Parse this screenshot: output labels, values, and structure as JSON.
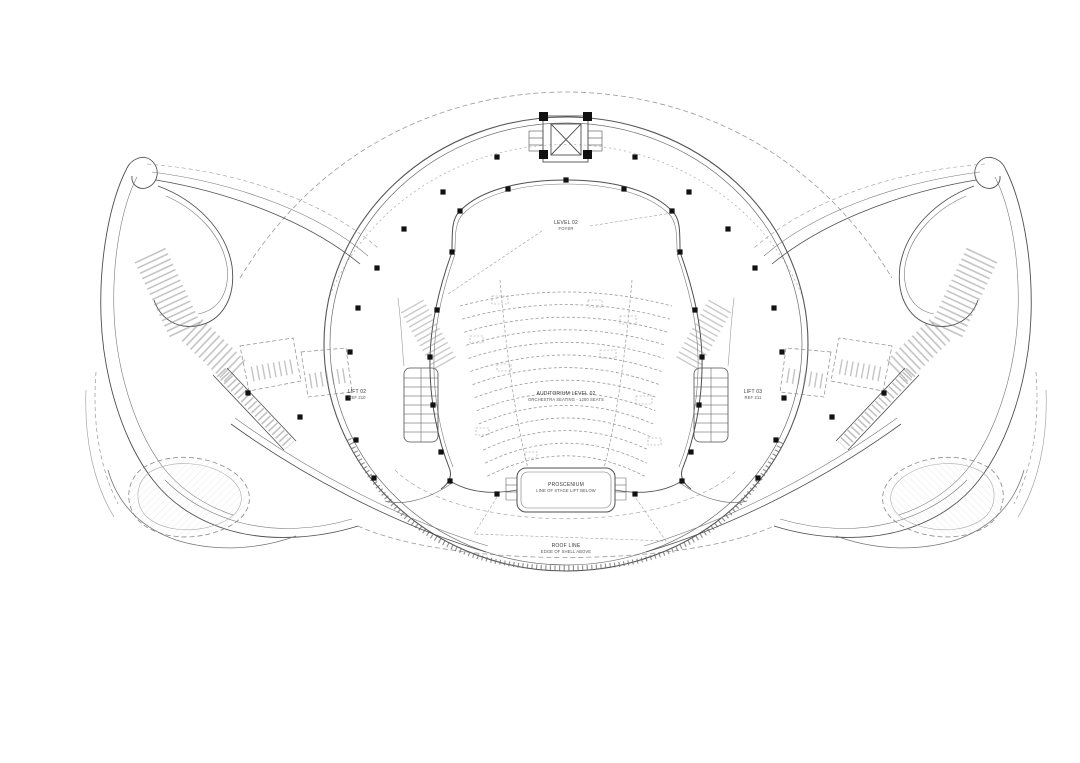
{
  "page": {
    "background": "#ffffff",
    "line_color": "#4f4f4f",
    "light_line_color": "#9a9a9a",
    "column_color": "#111111"
  },
  "drawing": {
    "type": "theatre-auditorium-floor-plan",
    "annotations": {
      "top": {
        "line1": "LEVEL 02",
        "line2": "FOYER"
      },
      "auditorium": {
        "line1": "AUDITORIUM LEVEL 02",
        "line2": "ORCHESTRA SEATING - 1200 SEATS"
      },
      "left": {
        "line1": "LIFT 02",
        "line2": "REF 210"
      },
      "right": {
        "line1": "LIFT 03",
        "line2": "REF 211"
      },
      "stage": {
        "line1": "PROSCENIUM",
        "line2": "LINE OF STAGE LIFT BELOW"
      },
      "bottom": {
        "line1": "ROOF LINE",
        "line2": "EDGE OF SHELL ABOVE"
      }
    },
    "auditorium_plan": {
      "seat_rows": 14
    }
  }
}
